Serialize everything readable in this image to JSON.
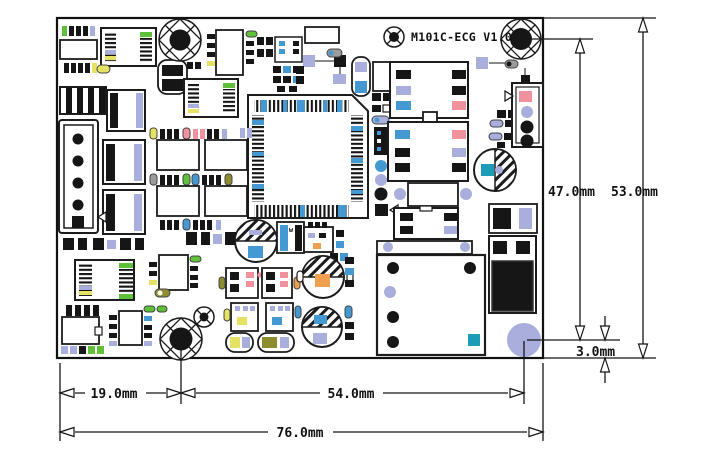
{
  "title": "M101C-ECG V1.0",
  "component_marking_w": "w",
  "dimensions": {
    "hole_to_pad_height": "47.0mm",
    "board_height": "53.0mm",
    "pad_edge_offset": "3.0mm",
    "edge_to_hole": "19.0mm",
    "hole_to_pad_width": "54.0mm",
    "board_width": "76.0mm"
  },
  "colors": {
    "outline": "#161616",
    "lavender": "#a9aedd",
    "blue": "#4599d2",
    "pink": "#f2919e",
    "yellow": "#e6e264",
    "green": "#5fc13a",
    "orange": "#efa04e",
    "olive": "#8d8d30",
    "teal": "#1d9cb8",
    "gray": "#9b9b9b"
  }
}
